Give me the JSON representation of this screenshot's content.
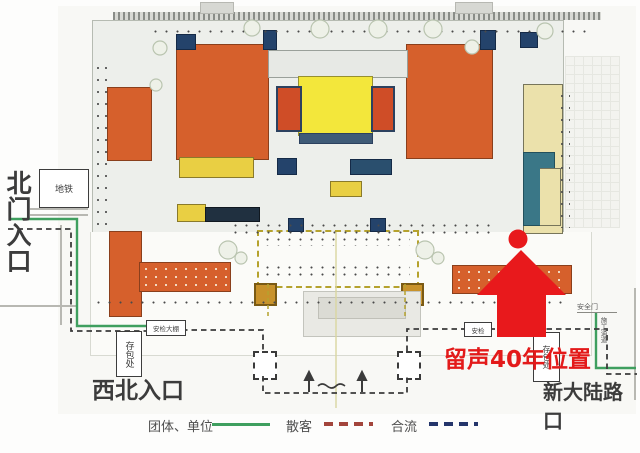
{
  "map": {
    "title": "场馆一层平面导览图",
    "entrances": {
      "north_gate": "北门入口",
      "northwest": "西北入口",
      "southeast_corner": "新大陆路口"
    },
    "highlight": {
      "label": "留声40年位置",
      "marker": "red-up-arrow-with-dot",
      "color": "#e8191c"
    },
    "facilities": {
      "subway": "地铁",
      "security_tent": "安检大棚",
      "security_check": "安检",
      "bag_storage": "存包处",
      "safety_gate": "安全门",
      "side_passage": "施工通道"
    },
    "legend": {
      "group_units": {
        "label": "团体、单位",
        "line": "solid",
        "color": "#3f9f5f"
      },
      "individual": {
        "label": "散客",
        "line": "dashed",
        "color": "#a3453c"
      },
      "merged": {
        "label": "合流",
        "line": "dashed",
        "color": "#24356b"
      }
    },
    "plan_colors": {
      "exhibit_hall_orange": "#d6602c",
      "central_hall_yellow": "#f3e73b",
      "east_wing_cream": "#ebe1ab",
      "service_teal": "#3a7787",
      "route_visitor_dash": "#3b3b3b",
      "route_group_green": "#3f9f5f"
    }
  }
}
